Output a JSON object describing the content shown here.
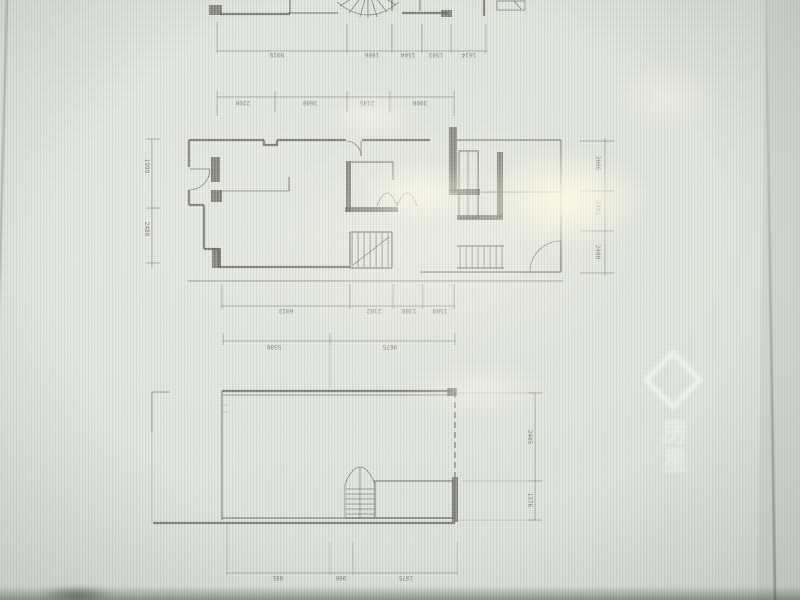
{
  "watermark": {
    "text": "房星"
  },
  "dims": {
    "a": [
      "9019",
      "1606",
      "1504",
      "1503",
      "1614"
    ],
    "b": [
      "2200",
      "3600",
      "2145",
      "3000"
    ],
    "mid_bottom": [
      "6013",
      "2102",
      "1309",
      "1509"
    ],
    "mid_left": [
      "1999",
      "2480"
    ],
    "mid_right": [
      "2006",
      "2401",
      "2400"
    ],
    "low_top": [
      "5500",
      "9675"
    ],
    "low_right": [
      "2405",
      "1376"
    ],
    "low_bottom": [
      "995",
      "900",
      "1975"
    ]
  },
  "colors": {
    "paper": "#dde1d9",
    "ink": "#4d4f45",
    "glare": "#fffce6"
  }
}
